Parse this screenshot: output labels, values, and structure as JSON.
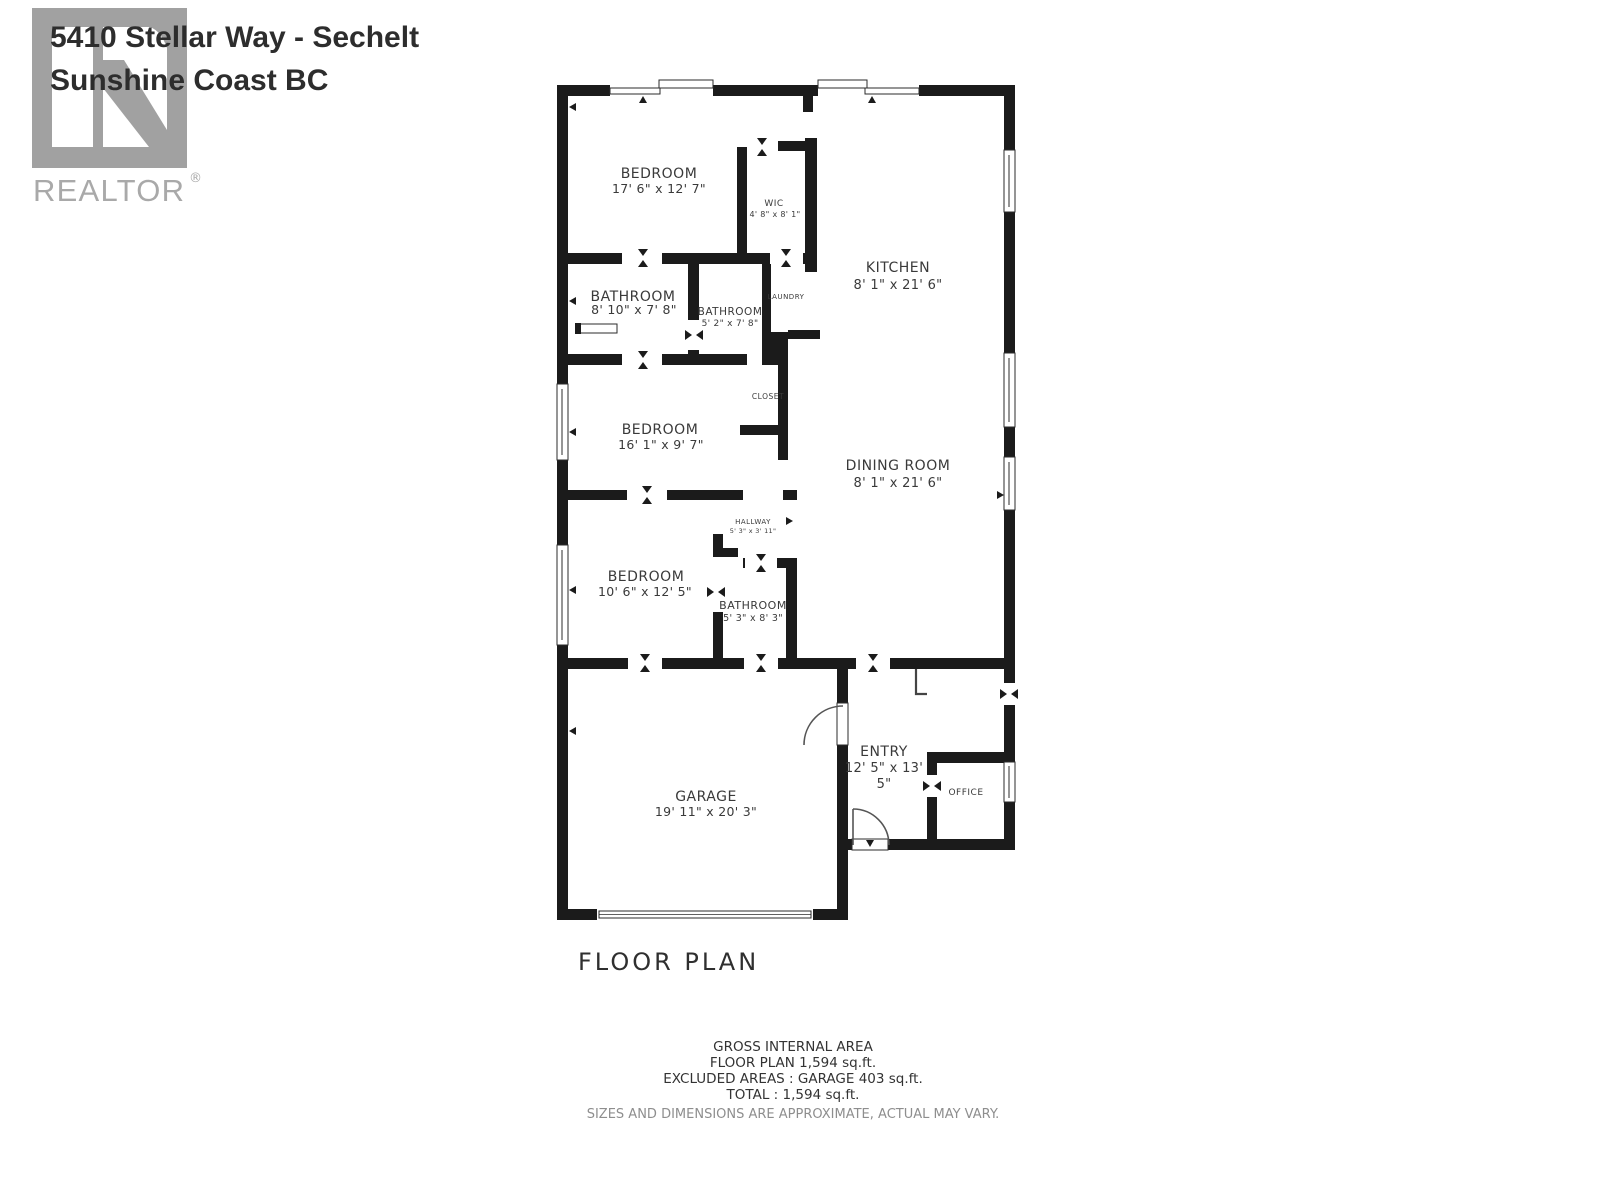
{
  "header": {
    "address_line1": "5410 Stellar Way -  Sechelt",
    "address_line2": "Sunshine Coast BC"
  },
  "logo": {
    "brand": "REALTOR",
    "registered_mark": "®"
  },
  "plan": {
    "caption": "FLOOR PLAN",
    "rooms": {
      "bedroom1": {
        "name": "BEDROOM",
        "dims": "17' 6\" x 12' 7\""
      },
      "wic": {
        "name": "WIC",
        "dims": "4' 8\" x 8' 1\""
      },
      "kitchen": {
        "name": "KITCHEN",
        "dims": "8' 1\" x 21' 6\""
      },
      "bathroom1": {
        "name": "BATHROOM",
        "dims": "8' 10\" x 7' 8\""
      },
      "bathroom2": {
        "name": "BATHROOM",
        "dims": "5' 2\" x 7' 8\""
      },
      "laundry": {
        "name": "LAUNDRY"
      },
      "closet": {
        "name": "CLOSET"
      },
      "bedroom2": {
        "name": "BEDROOM",
        "dims": "16' 1\" x 9' 7\""
      },
      "dining": {
        "name": "DINING ROOM",
        "dims": "8' 1\" x 21' 6\""
      },
      "hallway": {
        "name": "HALLWAY",
        "dims": "5' 3\" x 3' 11\""
      },
      "bedroom3": {
        "name": "BEDROOM",
        "dims": "10' 6\" x 12' 5\""
      },
      "bathroom3": {
        "name": "BATHROOM",
        "dims": "5' 3\" x 8' 3\""
      },
      "garage": {
        "name": "GARAGE",
        "dims": "19' 11\" x 20' 3\""
      },
      "entry": {
        "name": "ENTRY",
        "dims_line1": "12' 5\" x 13'",
        "dims_line2": "5\""
      },
      "office": {
        "name": "OFFICE"
      }
    }
  },
  "summary": {
    "line1": "GROSS INTERNAL AREA",
    "line2": "FLOOR PLAN 1,594 sq.ft.",
    "line3": "EXCLUDED AREAS :  GARAGE 403 sq.ft.",
    "line4": "TOTAL :  1,594 sq.ft.",
    "disclaimer": "SIZES AND DIMENSIONS ARE APPROXIMATE, ACTUAL MAY VARY."
  }
}
